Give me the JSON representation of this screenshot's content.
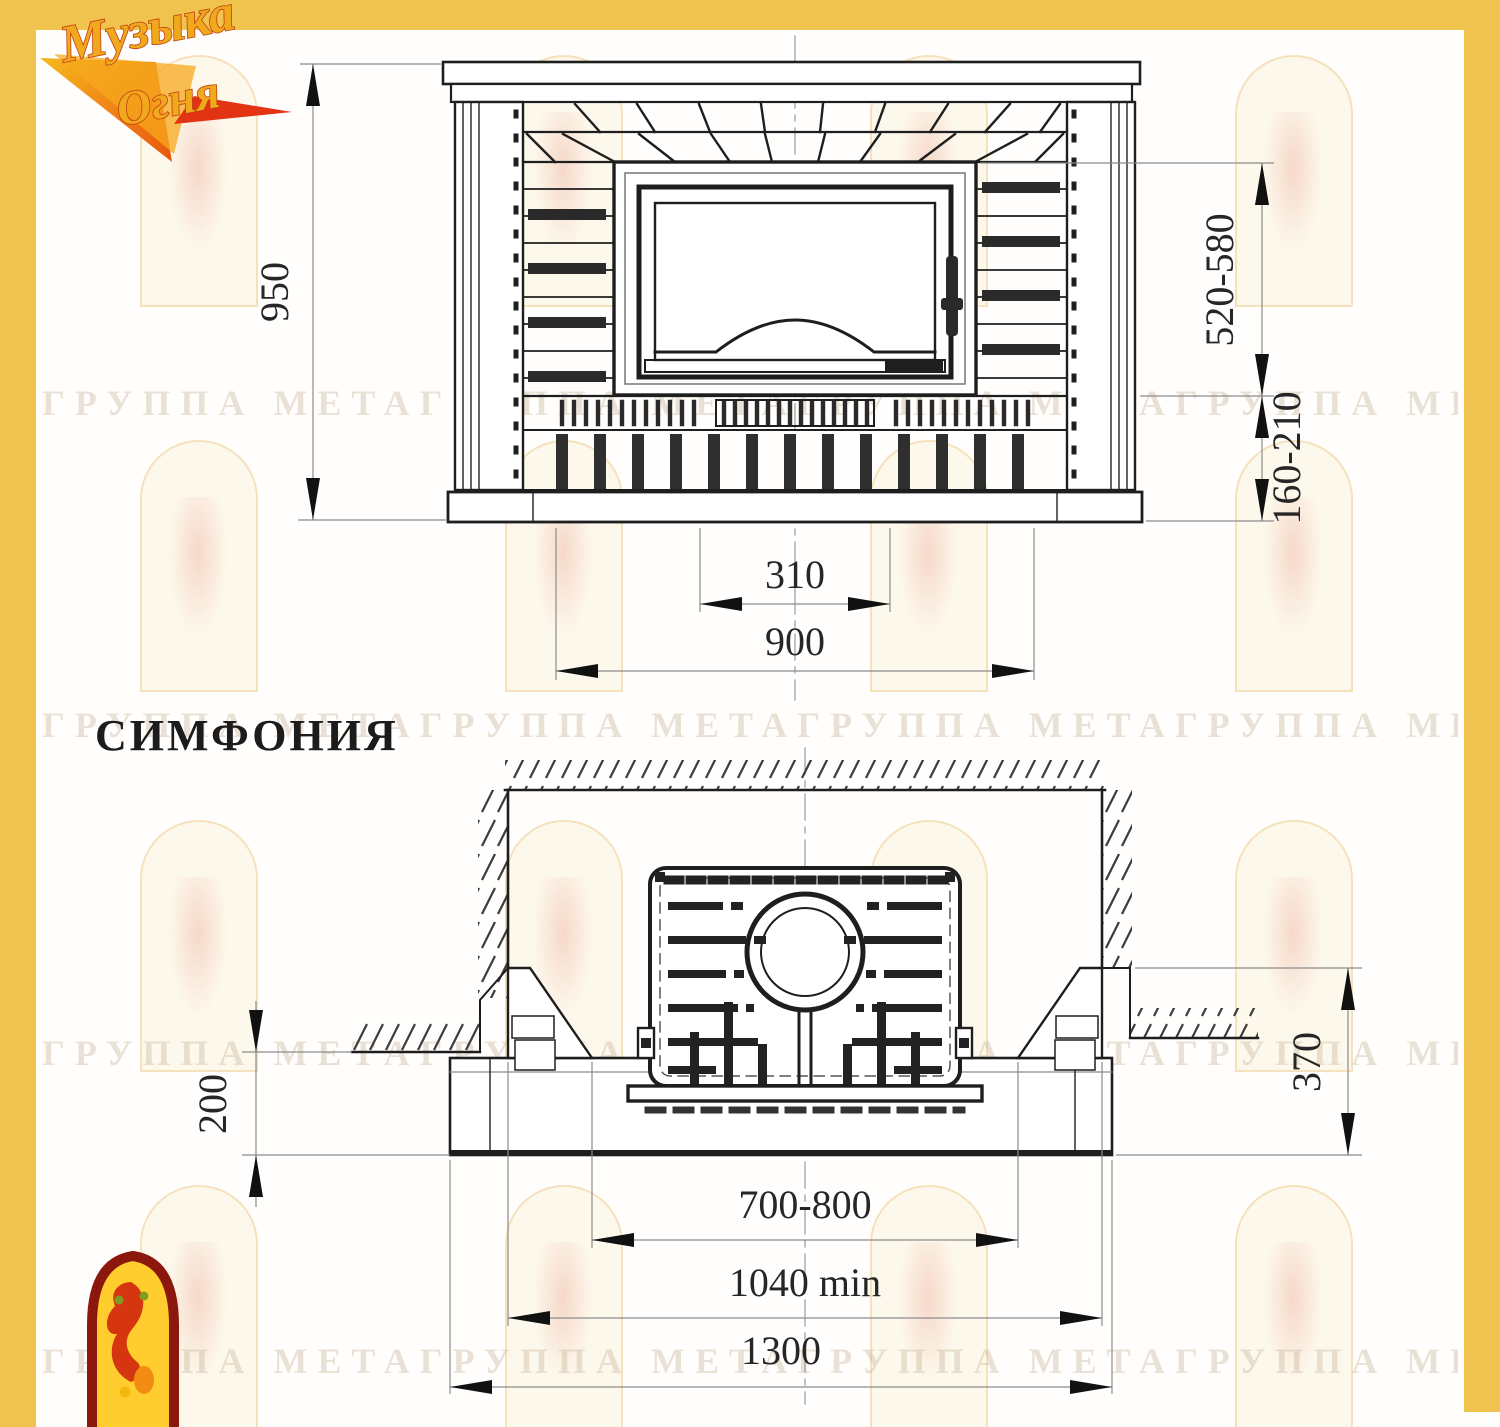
{
  "page": {
    "model_title": "СИМФОНИЯ"
  },
  "brand": {
    "logo_top": "Музыка",
    "logo_bottom": "Огня"
  },
  "front_view": {
    "dims": {
      "overall_height": "950",
      "firebox_to_hearth": "520-580",
      "hearth_to_floor": "160-210",
      "grate_width": "310",
      "hearth_width": "900"
    }
  },
  "plan_view": {
    "dims": {
      "front_ledge": "200",
      "side_wall_depth": "370",
      "portal_opening": "700-800",
      "niche_width": "1040 min",
      "base_width": "1300"
    }
  },
  "watermark": {
    "row_text": "ГРУППА МЕТАГРУППА МЕТАГРУППА МЕТАГРУППА МЕТАГРУППА МЕТАГРУППА МЕТА"
  }
}
